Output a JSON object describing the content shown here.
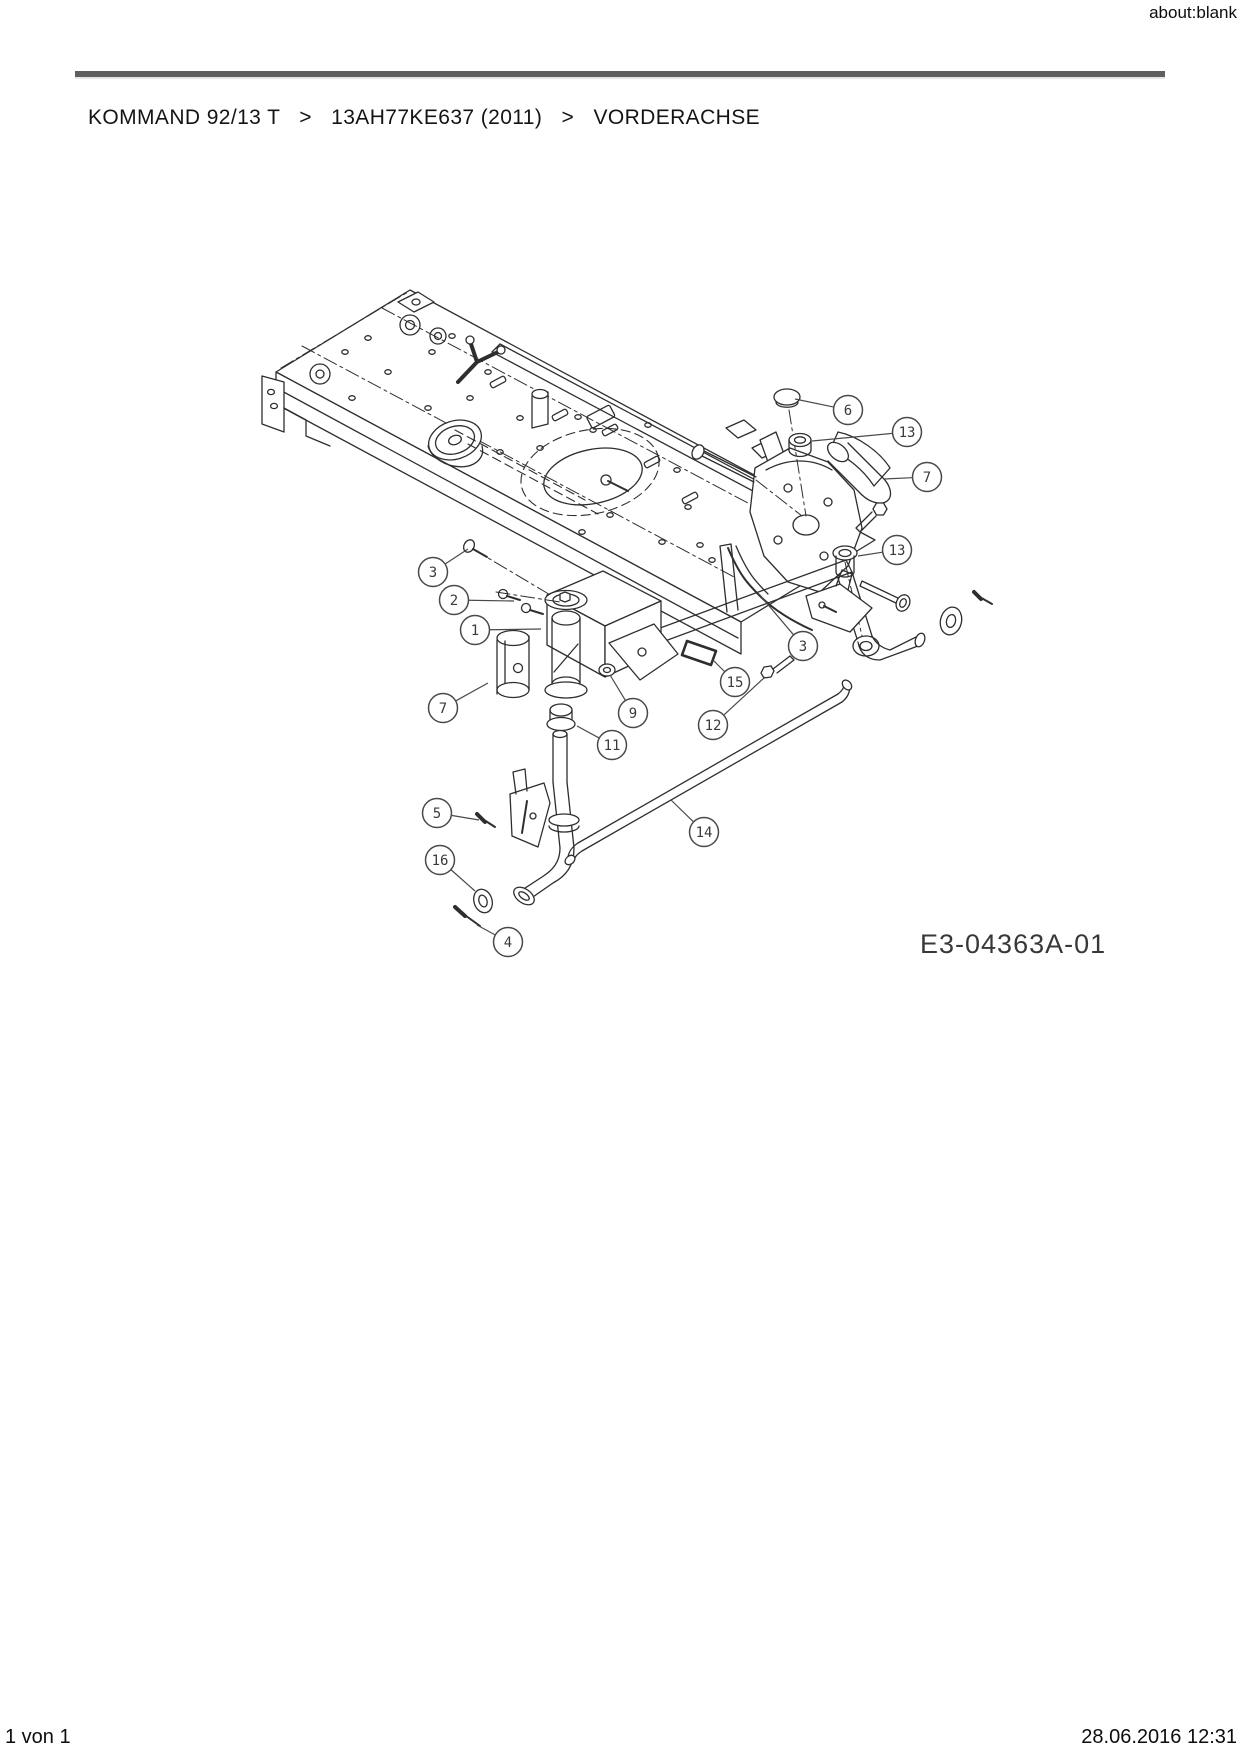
{
  "window": {
    "url_label": "about:blank"
  },
  "breadcrumb": {
    "items": [
      "KOMMAND 92/13 T",
      "13AH77KE637 (2011)",
      "VORDERACHSE"
    ],
    "separator": ">"
  },
  "diagram": {
    "title": "VORDERACHSE exploded parts drawing",
    "code_label": "E3-04363A-01",
    "callouts": [
      {
        "label": "6",
        "cx": 848,
        "cy": 410,
        "tx": 795,
        "ty": 399
      },
      {
        "label": "13",
        "cx": 907,
        "cy": 432,
        "tx": 812,
        "ty": 441
      },
      {
        "label": "7",
        "cx": 927,
        "cy": 477,
        "tx": 884,
        "ty": 479
      },
      {
        "label": "13",
        "cx": 897,
        "cy": 550,
        "tx": 858,
        "ty": 556
      },
      {
        "label": "3",
        "cx": 433,
        "cy": 572,
        "tx": 468,
        "ty": 549
      },
      {
        "label": "2",
        "cx": 454,
        "cy": 600,
        "tx": 514,
        "ty": 601
      },
      {
        "label": "1",
        "cx": 475,
        "cy": 630,
        "tx": 541,
        "ty": 629
      },
      {
        "label": "7",
        "cx": 443,
        "cy": 708,
        "tx": 488,
        "ty": 683
      },
      {
        "label": "9",
        "cx": 633,
        "cy": 713,
        "tx": 610,
        "ty": 675
      },
      {
        "label": "11",
        "cx": 612,
        "cy": 745,
        "tx": 577,
        "ty": 726
      },
      {
        "label": "15",
        "cx": 735,
        "cy": 682,
        "tx": 713,
        "ty": 660
      },
      {
        "label": "3",
        "cx": 803,
        "cy": 646,
        "tx": 759,
        "ty": 594
      },
      {
        "label": "12",
        "cx": 713,
        "cy": 725,
        "tx": 765,
        "ty": 677
      },
      {
        "label": "14",
        "cx": 704,
        "cy": 832,
        "tx": 671,
        "ty": 800
      },
      {
        "label": "5",
        "cx": 437,
        "cy": 813,
        "tx": 479,
        "ty": 820
      },
      {
        "label": "16",
        "cx": 440,
        "cy": 860,
        "tx": 475,
        "ty": 891
      },
      {
        "label": "4",
        "cx": 508,
        "cy": 942,
        "tx": 477,
        "ty": 925
      }
    ]
  },
  "footer": {
    "page_info": "1 von 1",
    "timestamp": "28.06.2016 12:31"
  },
  "colors": {
    "line": "#2e2e2e",
    "rule": "#5f5f5f",
    "callout": "#4a4a4a",
    "text": "#141414"
  }
}
